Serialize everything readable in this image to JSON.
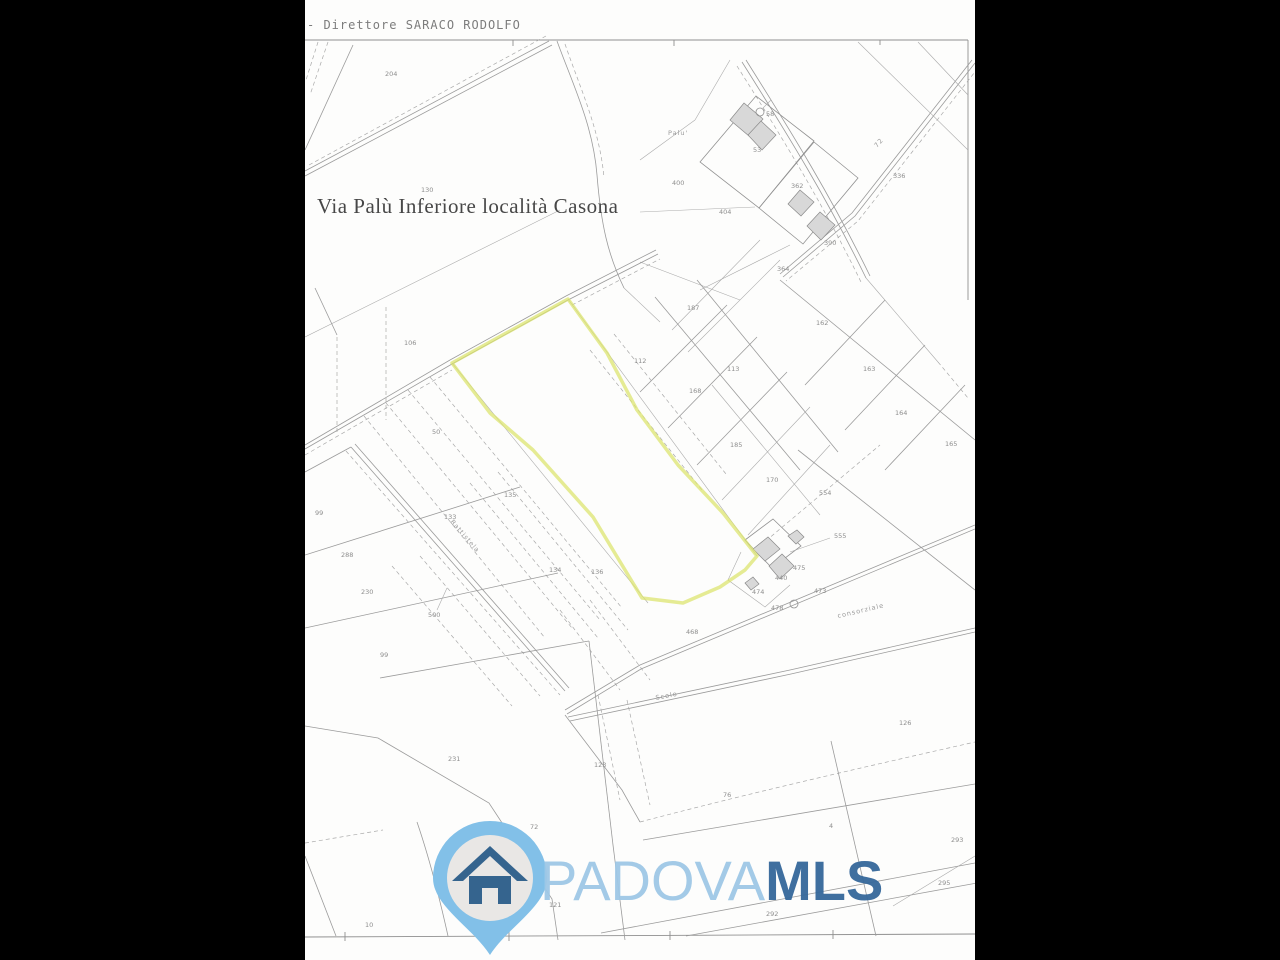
{
  "page": {
    "header_text": "- Direttore SARACO RODOLFO",
    "map_title": "Via Palù Inferiore località Casona",
    "background_color": "#000000",
    "paper_color": "#fdfdfc"
  },
  "map": {
    "line_color": "#9b9b9b",
    "highlight_color": "#dbe36b",
    "parcel_labels": [
      {
        "text": "204",
        "x": 385,
        "y": 76
      },
      {
        "text": "130",
        "x": 421,
        "y": 192,
        "size": 5.5
      },
      {
        "text": "400",
        "x": 672,
        "y": 185
      },
      {
        "text": "404",
        "x": 719,
        "y": 214
      },
      {
        "text": "53",
        "x": 753,
        "y": 152
      },
      {
        "text": "58",
        "x": 766,
        "y": 116,
        "size": 5.5
      },
      {
        "text": "362",
        "x": 791,
        "y": 188
      },
      {
        "text": "390",
        "x": 824,
        "y": 245
      },
      {
        "text": "364",
        "x": 777,
        "y": 271
      },
      {
        "text": "336",
        "x": 893,
        "y": 178
      },
      {
        "text": "187",
        "x": 687,
        "y": 310
      },
      {
        "text": "112",
        "x": 634,
        "y": 363
      },
      {
        "text": "113",
        "x": 727,
        "y": 371
      },
      {
        "text": "162",
        "x": 816,
        "y": 325
      },
      {
        "text": "163",
        "x": 863,
        "y": 371
      },
      {
        "text": "164",
        "x": 895,
        "y": 415
      },
      {
        "text": "165",
        "x": 945,
        "y": 446
      },
      {
        "text": "168",
        "x": 689,
        "y": 393
      },
      {
        "text": "185",
        "x": 730,
        "y": 447
      },
      {
        "text": "170",
        "x": 766,
        "y": 482
      },
      {
        "text": "554",
        "x": 819,
        "y": 495
      },
      {
        "text": "555",
        "x": 834,
        "y": 538,
        "size": 5.5
      },
      {
        "text": "475",
        "x": 793,
        "y": 570,
        "size": 5.5
      },
      {
        "text": "440",
        "x": 775,
        "y": 580,
        "size": 5.5
      },
      {
        "text": "474",
        "x": 752,
        "y": 594,
        "size": 5.5
      },
      {
        "text": "473",
        "x": 814,
        "y": 593,
        "size": 5.5
      },
      {
        "text": "478",
        "x": 771,
        "y": 610,
        "size": 5.5
      },
      {
        "text": "468",
        "x": 686,
        "y": 634
      },
      {
        "text": "106",
        "x": 404,
        "y": 345
      },
      {
        "text": "50",
        "x": 432,
        "y": 434,
        "size": 11
      },
      {
        "text": "99",
        "x": 315,
        "y": 515
      },
      {
        "text": "288",
        "x": 341,
        "y": 557
      },
      {
        "text": "133",
        "x": 444,
        "y": 519
      },
      {
        "text": "135",
        "x": 504,
        "y": 497
      },
      {
        "text": "230",
        "x": 361,
        "y": 594
      },
      {
        "text": "500",
        "x": 428,
        "y": 617,
        "size": 5.5
      },
      {
        "text": "99",
        "x": 380,
        "y": 657
      },
      {
        "text": "134",
        "x": 549,
        "y": 572
      },
      {
        "text": "136",
        "x": 591,
        "y": 574
      },
      {
        "text": "231",
        "x": 448,
        "y": 761
      },
      {
        "text": "123",
        "x": 594,
        "y": 767
      },
      {
        "text": "72",
        "x": 530,
        "y": 829
      },
      {
        "text": "76",
        "x": 723,
        "y": 797
      },
      {
        "text": "4",
        "x": 829,
        "y": 828
      },
      {
        "text": "126",
        "x": 899,
        "y": 725
      },
      {
        "text": "293",
        "x": 951,
        "y": 842
      },
      {
        "text": "295",
        "x": 938,
        "y": 885
      },
      {
        "text": "292",
        "x": 766,
        "y": 916
      },
      {
        "text": "121",
        "x": 549,
        "y": 907,
        "size": 5.5
      },
      {
        "text": "10",
        "x": 365,
        "y": 927,
        "size": 5.5
      }
    ],
    "place_labels": [
      {
        "text": "Palu'",
        "x": 668,
        "y": 135,
        "rotate": 0
      },
      {
        "text": "72",
        "x": 877,
        "y": 148,
        "rotate": -48
      },
      {
        "text": "Battistela",
        "x": 450,
        "y": 522,
        "rotate": 49,
        "size": 5.5
      },
      {
        "text": "Scolo",
        "x": 656,
        "y": 700,
        "rotate": -11
      },
      {
        "text": "consorziale",
        "x": 838,
        "y": 618,
        "rotate": -13,
        "size": 5
      }
    ]
  },
  "watermark": {
    "brand_light": "PADOVA",
    "brand_bold": "MLS",
    "pin_color": "#82c0e8",
    "pin_inner_color": "#e9e7e5",
    "house_color": "#35648e",
    "text_light_color": "#9fc8e6",
    "text_bold_color": "#35689b"
  }
}
